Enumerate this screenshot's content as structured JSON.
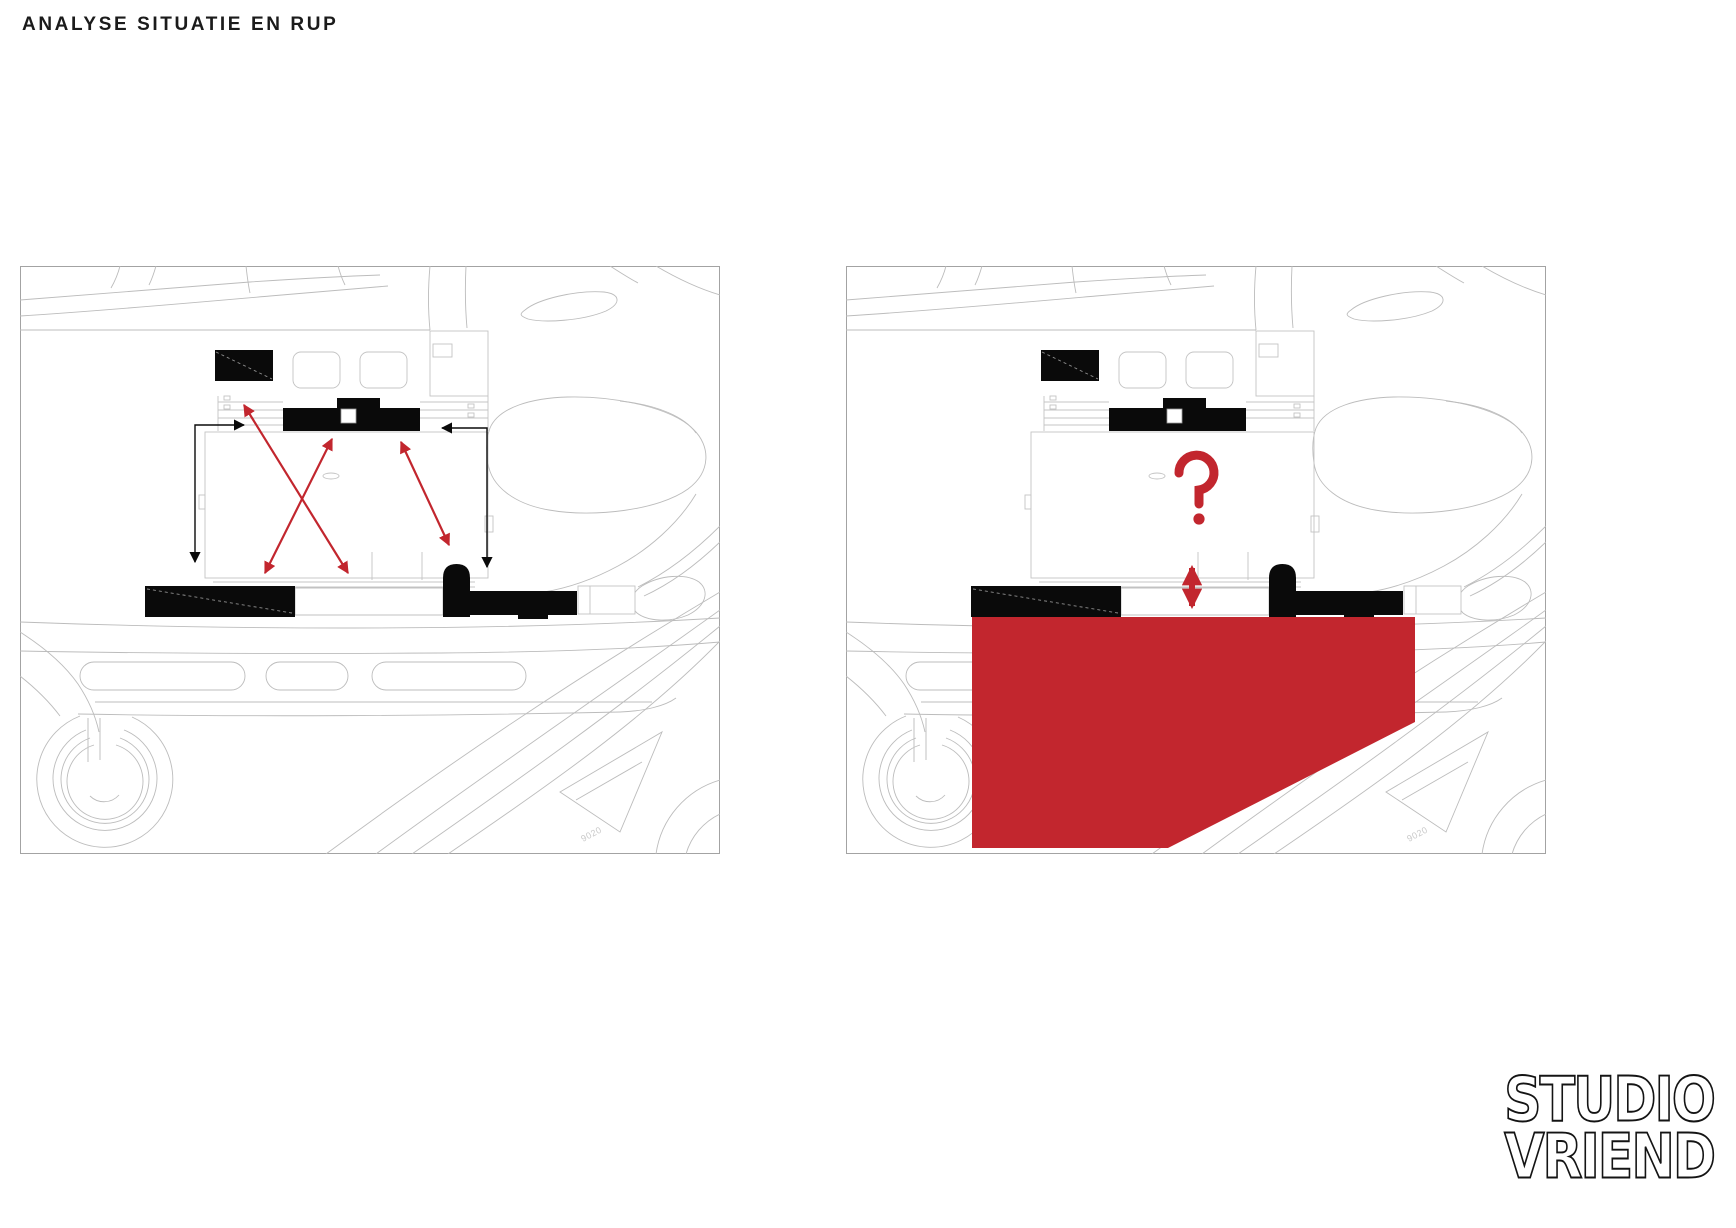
{
  "title": "ANALYSE SITUATIE EN RUP",
  "panels": {
    "left": {
      "id": "situatie",
      "label_9020": "9020"
    },
    "right": {
      "id": "rup",
      "label_9020": "9020",
      "question_mark": "?"
    }
  },
  "annotations": {
    "accent_red": "#C2262E",
    "building_black": "#0a0a0a",
    "map_line_gray": "#b8b8b8"
  },
  "logo": {
    "line1": "STUDIO",
    "line2": "VRIEND"
  }
}
